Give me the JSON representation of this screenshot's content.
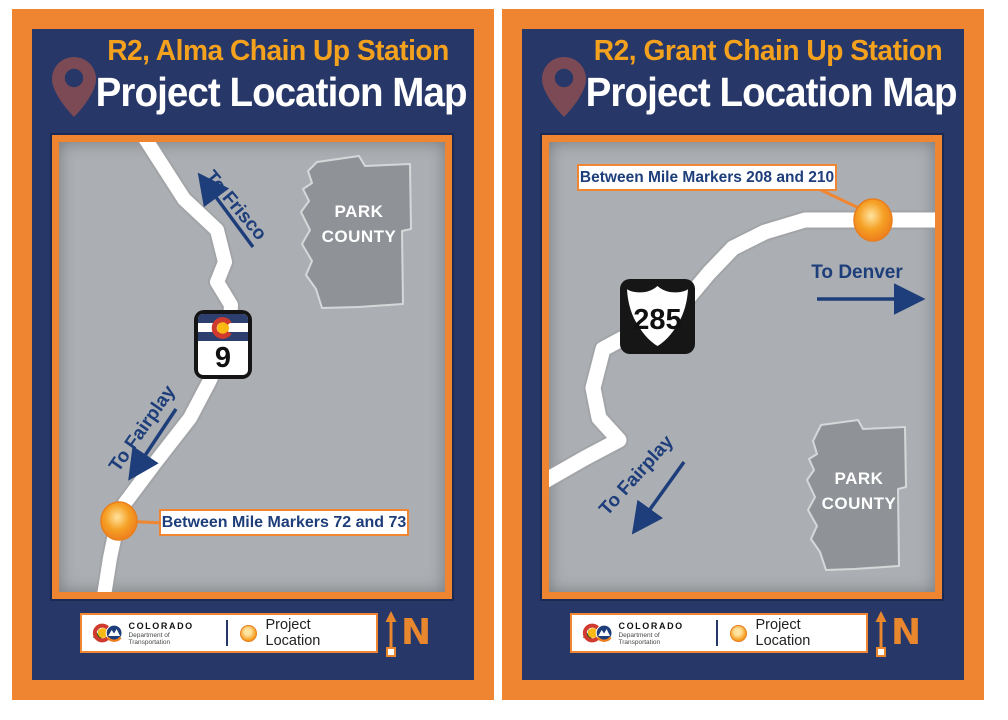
{
  "colors": {
    "border_orange": "#ef8431",
    "panel_navy": "#273768",
    "map_gray": "#abaeb2",
    "county_gray": "#8f9397",
    "text_navy": "#1d3e7a",
    "title_orange": "#f4a21d",
    "dot_orange": "#f5a125",
    "road_white": "#ffffff"
  },
  "panels": [
    {
      "title_line1": "R2, Alma Chain Up Station",
      "title_line2": "Project Location Map",
      "marker_label": "Between Mile Markers 72 and 73",
      "direction_top": "To Frisco",
      "direction_bottom": "To Fairplay",
      "county_line1": "PARK",
      "county_line2": "COUNTY",
      "shield": {
        "type": "colorado-state-highway",
        "number": "9"
      }
    },
    {
      "title_line1": "R2, Grant Chain Up Station",
      "title_line2": "Project Location Map",
      "marker_label": "Between Mile Markers 208 and 210",
      "direction_top": "To Denver",
      "direction_bottom": "To Fairplay",
      "county_line1": "PARK",
      "county_line2": "COUNTY",
      "shield": {
        "type": "us-route",
        "number": "285"
      }
    }
  ],
  "legend": {
    "org": "COLORADO",
    "dept": "Department of Transportation",
    "item_label": "Project Location",
    "north_label": "N"
  }
}
